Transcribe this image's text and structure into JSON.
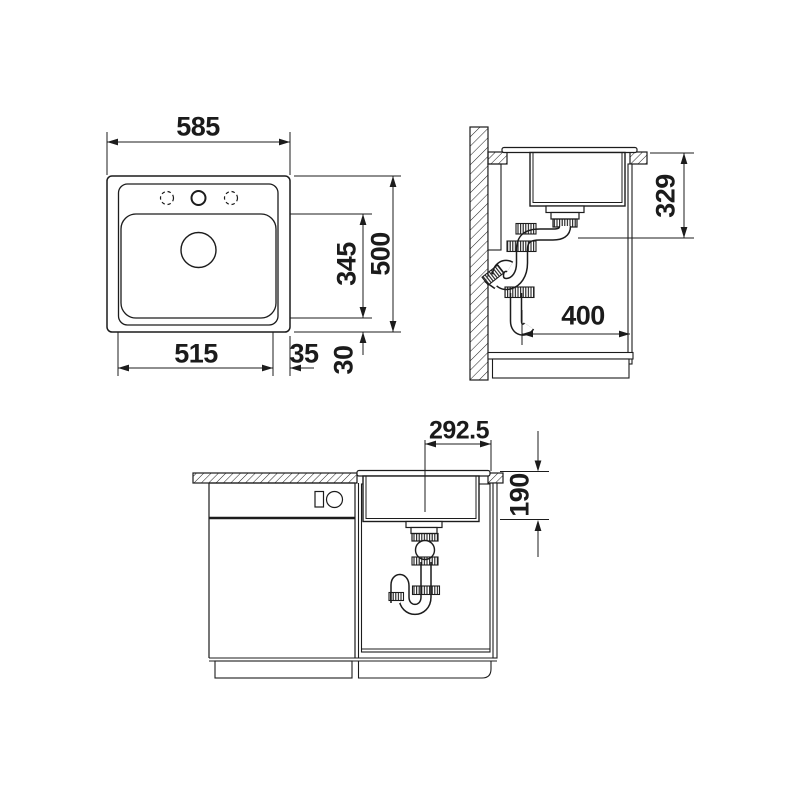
{
  "drawing": {
    "type": "sink installation technical drawing",
    "colors": {
      "background": "#ffffff",
      "line": "#1c1c1c",
      "text": "#1b1b1b"
    },
    "plan_view": {
      "overall_width": "585",
      "cutout_width": "515",
      "edge_gap": "35",
      "bottom_gap": "30",
      "basin_length": "345",
      "overall_depth": "500"
    },
    "side_view": {
      "outlet_height": "329",
      "outlet_offset": "400"
    },
    "front_view": {
      "drain_offset": "292.5",
      "basin_depth": "190"
    }
  }
}
